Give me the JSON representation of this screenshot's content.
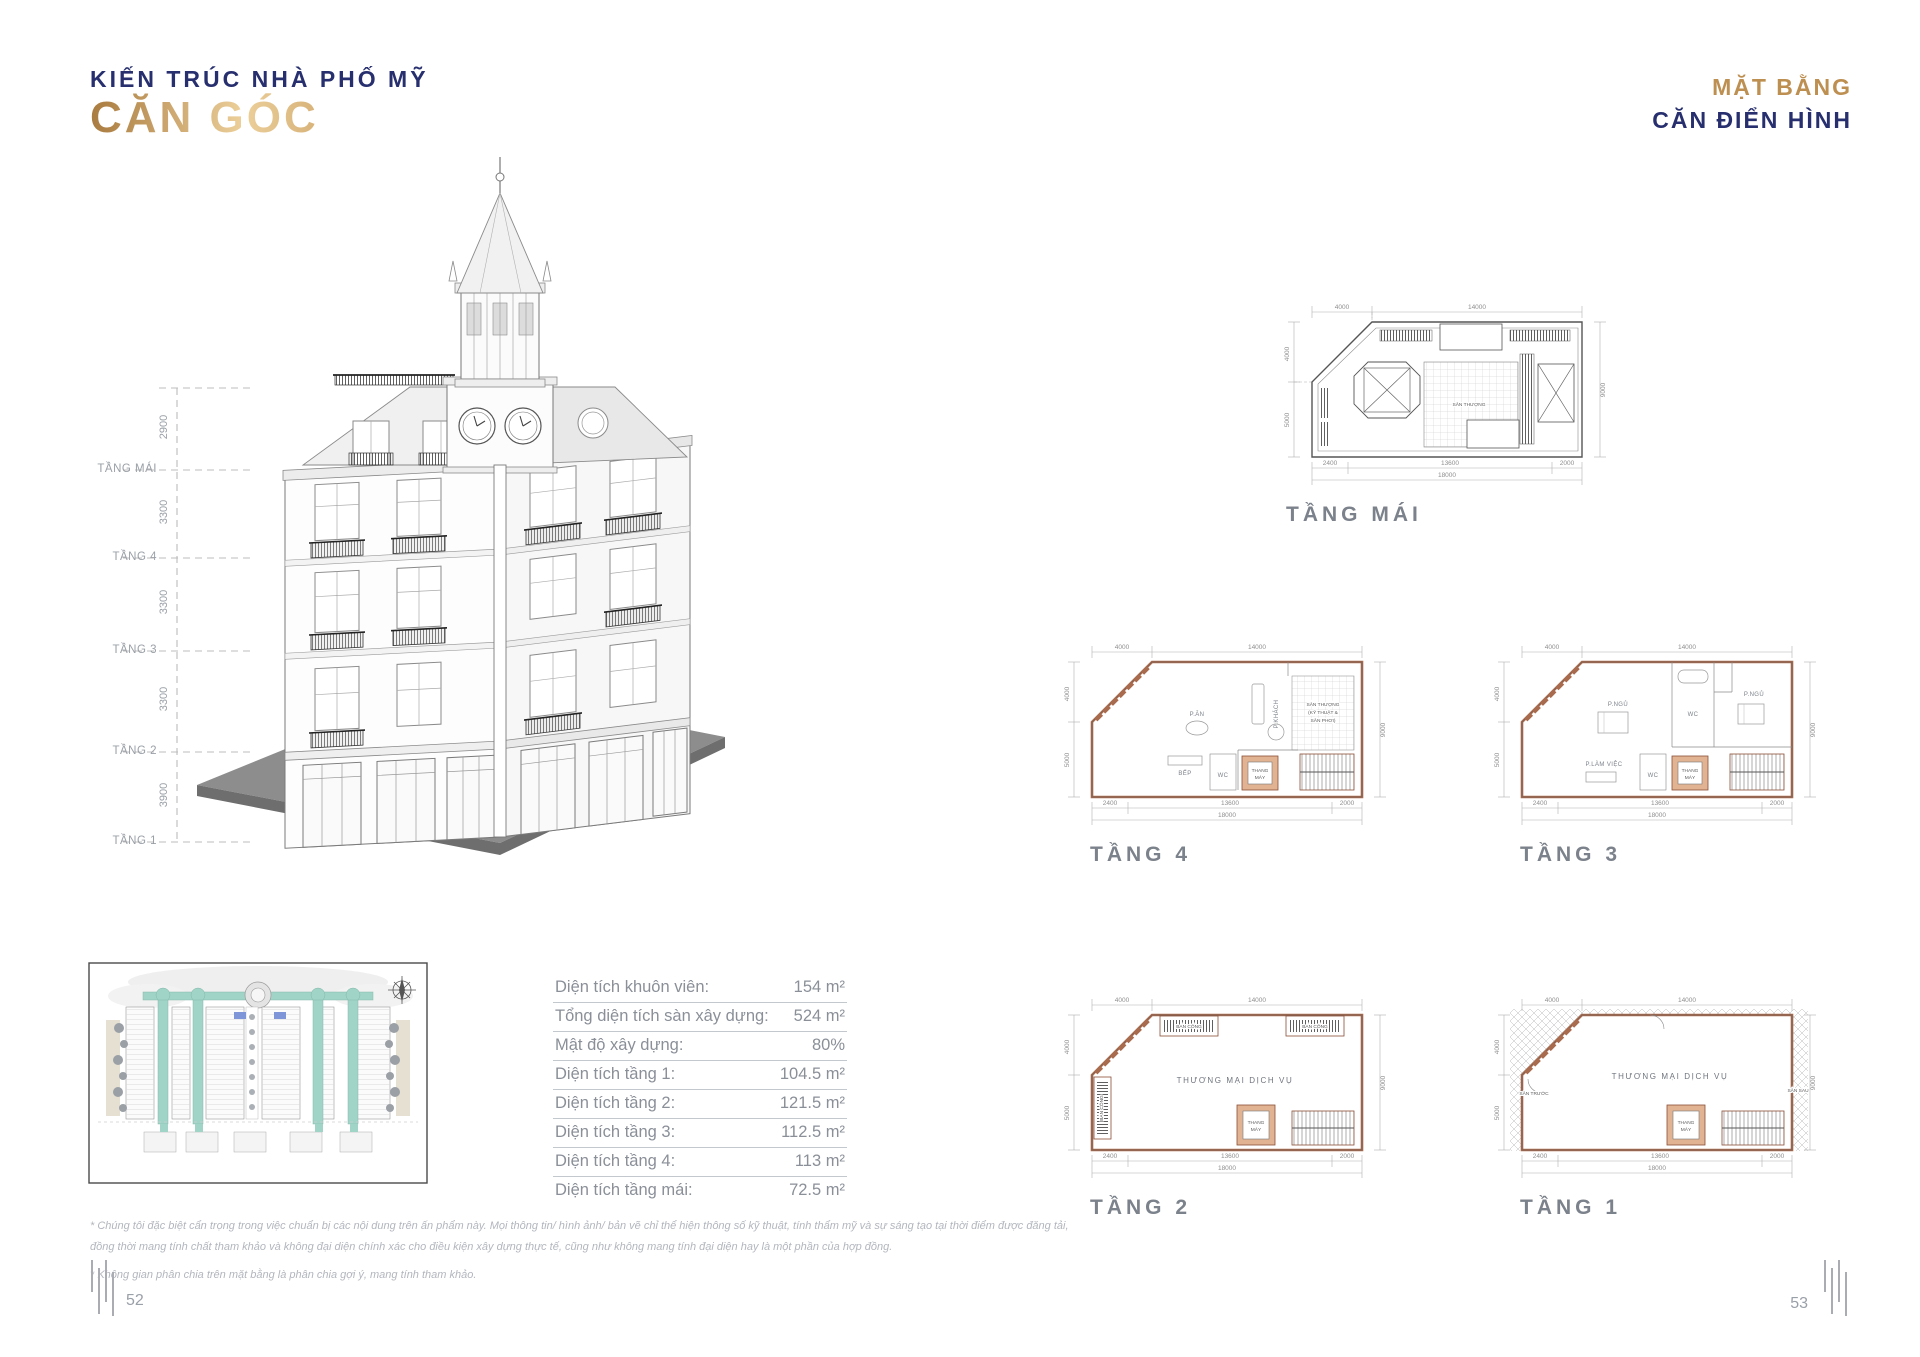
{
  "left_page": {
    "title_line1": "KIẾN TRÚC NHÀ PHỐ MỸ",
    "title_line2": "CĂN GÓC",
    "page_number": "52",
    "floor_scale": {
      "levels": [
        {
          "label": "TẦNG MÁI",
          "dim_above": "2900"
        },
        {
          "label": "TẦNG 4",
          "dim_above": "3300"
        },
        {
          "label": "TẦNG 3",
          "dim_above": "3300"
        },
        {
          "label": "TẦNG 2",
          "dim_above": "3300"
        },
        {
          "label": "TẦNG 1",
          "dim_above": "3900"
        }
      ]
    },
    "spec_table": {
      "rows": [
        {
          "label": "Diện tích khuôn viên:",
          "value": "154 m²"
        },
        {
          "label": "Tổng diện tích sàn xây dựng:",
          "value": "524 m²"
        },
        {
          "label": "Mật độ xây dựng:",
          "value": "80%"
        },
        {
          "label": "Diện tích tầng 1:",
          "value": "104.5 m²"
        },
        {
          "label": "Diện tích tầng 2:",
          "value": "121.5 m²"
        },
        {
          "label": "Diện tích tầng 3:",
          "value": "112.5 m²"
        },
        {
          "label": "Diện tích tầng 4:",
          "value": "113 m²"
        },
        {
          "label": "Diện tích tầng mái:",
          "value": "72.5 m²"
        }
      ]
    },
    "disclaimer": {
      "line1": "* Chúng tôi đặc biệt cẩn trọng trong việc chuẩn bị các nội dung trên ấn phẩm này. Mọi thông tin/ hình ảnh/ bản vẽ chỉ thể hiện thông số kỹ thuật, tính thẩm mỹ và sự sáng tạo tại thời điểm được đăng tải,",
      "line2": "đồng thời mang tính chất tham khảo và không đại diện chính xác cho điều kiện xây dựng thực tế, cũng như không mang tính đại diện hay là một phần của hợp đồng.",
      "line3": "* Không gian phân chia trên mặt bằng là phân chia gợi ý, mang tính tham khảo."
    }
  },
  "right_page": {
    "title_line1": "MẶT BẰNG",
    "title_line2": "CĂN ĐIỂN HÌNH",
    "page_number": "53",
    "plan_dims": {
      "top_left": "4000",
      "top_right": "14000",
      "left_top": "4000",
      "left_bottom": "5000",
      "right_side": "9000",
      "bottom_left": "2400",
      "bottom_mid": "13600",
      "bottom_right": "2000",
      "bottom_total": "18000"
    },
    "plans": [
      {
        "caption": "TẦNG MÁI",
        "rooms": {
          "terrace": "SÂN THƯỢNG"
        }
      },
      {
        "caption": "TẦNG 4",
        "rooms": {
          "dining": "P.ĂN",
          "living": "P.KHÁCH",
          "terrace_l1": "SÂN THƯỢNG",
          "terrace_l2": "(KỸ THUẬT &",
          "terrace_l3": "SÂN PHƠI)",
          "kitchen": "BẾP",
          "wc": "WC",
          "elevator_l1": "THANG",
          "elevator_l2": "MÁY"
        }
      },
      {
        "caption": "TẦNG 3",
        "rooms": {
          "bedroom_1": "P.NGỦ",
          "bedroom_2": "P.NGỦ",
          "wc_1": "WC",
          "wc_2": "WC",
          "office": "P.LÀM VIỆC",
          "elevator_l1": "THANG",
          "elevator_l2": "MÁY"
        }
      },
      {
        "caption": "TẦNG 2",
        "rooms": {
          "balcony_1": "BAN CÔNG",
          "balcony_2": "BAN CÔNG",
          "balcony_3": "BAN CÔNG",
          "commercial": "THƯƠNG MẠI DỊCH VỤ",
          "elevator_l1": "THANG",
          "elevator_l2": "MÁY"
        }
      },
      {
        "caption": "TẦNG 1",
        "rooms": {
          "commercial": "THƯƠNG MẠI DỊCH VỤ",
          "front_yard": "SÂN TRƯỚC",
          "back_yard": "SÂN SAU",
          "elevator_l1": "THANG",
          "elevator_l2": "MÁY"
        }
      }
    ]
  },
  "icons": {
    "compass": "compass-rose"
  },
  "colors": {
    "navy": "#272f6e",
    "gold": "#bd8f51",
    "gold_light": "#eccf9a",
    "copper_wall": "#a96b4e",
    "gray_text": "#8a8f98",
    "caption_gray": "#7c828b"
  }
}
